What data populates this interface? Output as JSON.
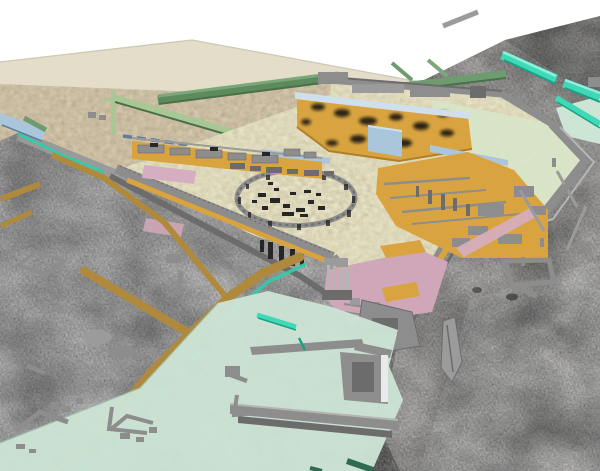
{
  "canvas": {
    "width": 600,
    "height": 471
  },
  "scene": {
    "kind": "3d-site-reconstruction-render",
    "features": [
      "survey-terrain",
      "plateau",
      "fortified-enclosure",
      "circular-monument",
      "harbor",
      "roads",
      "ruins"
    ]
  },
  "colors": {
    "background": "#ffffff",
    "terrain_light": "#c9c9c9",
    "terrain_mid": "#c0bfbd",
    "terrain_dark": "#8e8e8e",
    "terrain_bright": "#dadada",
    "plateau_flat": "#e4ddc9",
    "plateau_ground": "#d6c9ae",
    "plateau_edge_light": "#cfc8b3",
    "fort_ground": "#e7e3c4",
    "circle_ground": "#ebe7c8",
    "pale_green": "#d8e6c9",
    "mint": "#cde5d5",
    "mint_edge": "#9fc0ad",
    "orange": "#d9a440",
    "orange_dark": "#b07f28",
    "road": "#b08a3c",
    "wall_gray": "#8d8d8d",
    "wall_gray_dark": "#6c6c6c",
    "wall_gray_light": "#b5b5b5",
    "wall_gray_mid": "#9b9b9b",
    "white_pillar": "#eaeaea",
    "blue_wall": "#aac6da",
    "blue_wall_light": "#cfe0ec",
    "blue_steel": "#5b7f9b",
    "pink": "#d5aec2",
    "pink_dusty": "#cfa7b8",
    "rose_stripe": "#c9a0aa",
    "green_dark": "#5d8b5e",
    "green_mid": "#6f9b70",
    "green_light": "#a9c795",
    "green_highlight": "#7aa87b",
    "green_shadow": "#4a7049",
    "teal": "#3fd9b8",
    "teal_light": "#8ff0dc",
    "teal_dark": "#18a284",
    "teal_channel": "#38c9a6",
    "deep_green": "#2f6b52",
    "dark_feature": "#262626",
    "spot_black": "#101010"
  }
}
